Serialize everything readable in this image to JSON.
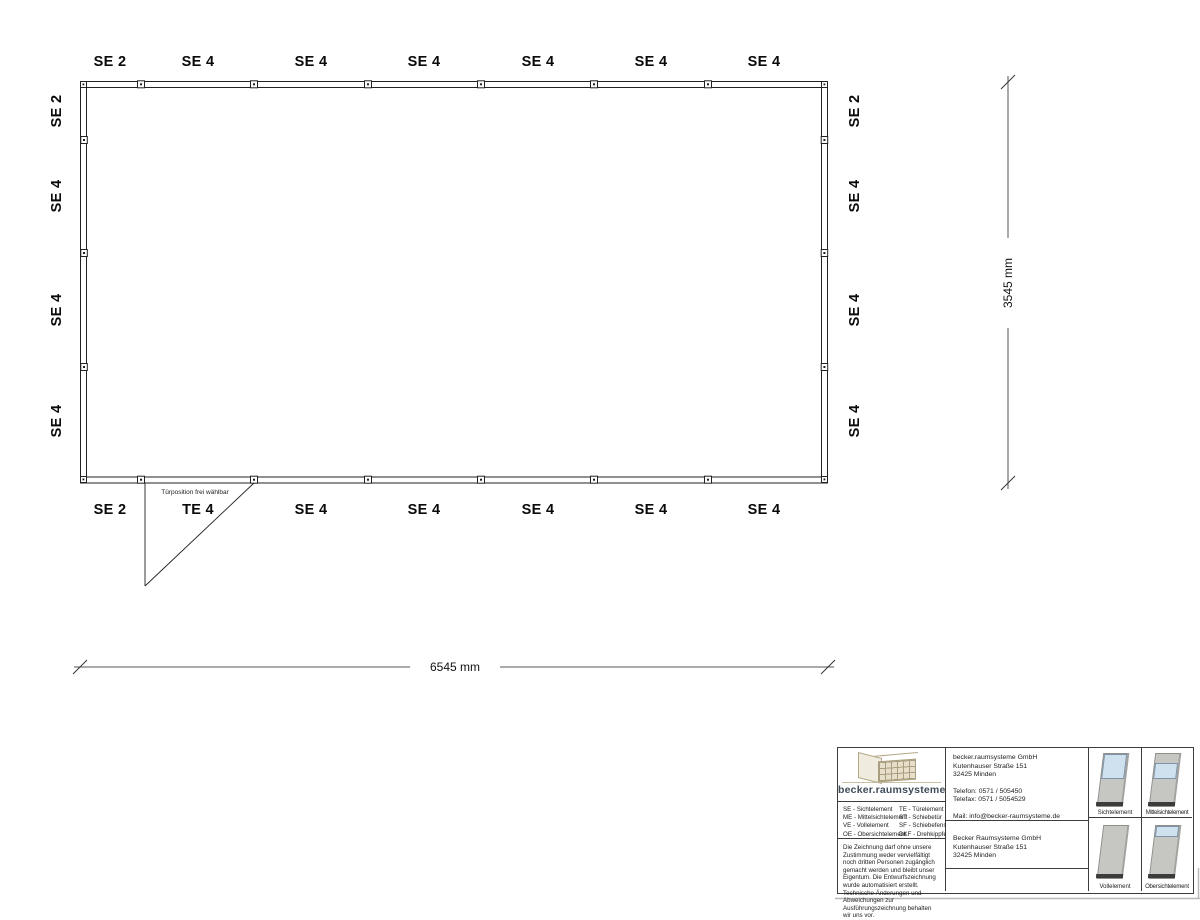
{
  "plan": {
    "top_labels": [
      "SE 2",
      "SE 4",
      "SE 4",
      "SE 4",
      "SE 4",
      "SE 4",
      "SE 4"
    ],
    "bottom_labels": [
      "SE 2",
      "TE 4",
      "SE 4",
      "SE 4",
      "SE 4",
      "SE 4",
      "SE 4"
    ],
    "left_labels": [
      "SE 2",
      "SE 4",
      "SE 4",
      "SE 4"
    ],
    "right_labels": [
      "SE 2",
      "SE 4",
      "SE 4",
      "SE 4"
    ],
    "door_note": "Türposition frei wählbar",
    "dim_width": "6545 mm",
    "dim_height": "3545 mm"
  },
  "title_block": {
    "brand": "becker.raumsysteme",
    "brand_reg": "®",
    "legend_rows": [
      [
        "SE - Sichtelement",
        "TE - Türelement"
      ],
      [
        "ME - Mittelsichtelement",
        "ST - Schiebetür"
      ],
      [
        "VE - Vollelement",
        "SF - Schiebefenster"
      ],
      [
        "OE - Obersichtelement",
        "DKF - Drehkippfenster"
      ]
    ],
    "disclaimer": "Die Zeichnung darf ohne unsere Zustimmung weder vervielfältigt noch dritten Personen zugänglich gemacht werden und bleibt unser Eigentum. Die Entwurfszeichnung wurde automatisiert erstellt. Technische Änderungen und Abweichungen zur Ausführungszeichnung behalten wir uns vor.",
    "contact": {
      "company": "becker.raumsysteme GmbH",
      "street": "Kutenhauser Straße 151",
      "city": "32425 Minden",
      "phone": "Telefon: 0571 / 505450",
      "fax": "Telefax: 0571 / 5054529",
      "mail": "Mail: info@becker-raumsysteme.de",
      "web": "Web: www.becker-raumsysteme.de"
    },
    "owner": {
      "company": "Becker Raumsysteme GmbH",
      "street": "Kutenhauser Straße 151",
      "city": "32425 Minden"
    },
    "element_labels": [
      "Sichtelement",
      "Mittelsichtelement",
      "Vollelement",
      "Obersichtelement"
    ]
  },
  "colors": {
    "wall_line": "#222222",
    "dim_line": "#555555",
    "brand_text": "#3f4c59",
    "logo_tan": "#b3a786",
    "glass": "#cfe0ee",
    "panel_gray": "#c6c6c3",
    "panel_base": "#3c3c3c"
  }
}
